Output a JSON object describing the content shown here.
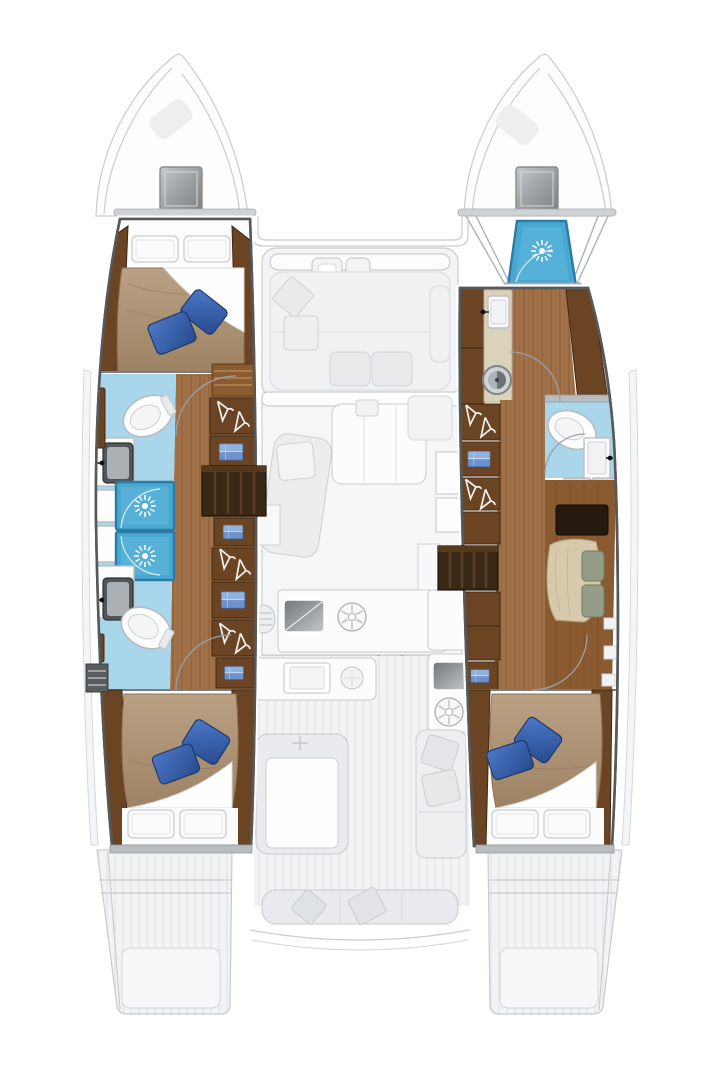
{
  "diagram": {
    "label": "catamaran-interior-deck-plan",
    "type": "boat-floor-plan",
    "orientation": "bow-up"
  },
  "palette": {
    "bg": "#ffffff",
    "ghost_fill": "#f3f4f6",
    "ghost_line": "#c9ccd0",
    "ghost_dark": "#aaadb0",
    "hull_outline": "#56585a",
    "teak": "#a1714a",
    "teak_line": "#7c5026",
    "wood_dark": "#6b4423",
    "wood_deep": "#3a2817",
    "wood_light": "#8a5a30",
    "bath_floor": "#a9d6ea",
    "shower_blue": "#49a8d2",
    "shower_border": "#2b7ba3",
    "duvet_light": "#bba183",
    "duvet_dark": "#9d8264",
    "pillow_blue_light": "#4d79c7",
    "pillow_blue_dark": "#274a8e",
    "beige": "#dbd2bb",
    "sofa": "#d7caac",
    "sill": "#b9bdc0",
    "white": "#fdfdfe",
    "steel_dark": "#70767a",
    "steel_light": "#c3c7ca",
    "clothes_blue_light": "#8fb3e0",
    "clothes_blue_dark": "#6e93cc"
  },
  "areas": {
    "port_hull": [
      "forward-double-berth",
      "forward-bathroom-toilet-sink",
      "shower-stall",
      "shower-stall",
      "aft-bathroom-toilet-sink",
      "wardrobe-column-hangers-shelves",
      "companionway-stairs",
      "aft-double-berth"
    ],
    "starboard_hull": [
      "bow-shower-stall",
      "forward-washroom-sink-washer",
      "toilet-compartment-sink",
      "wardrobe-column-hangers-shelves",
      "companionway-stairs",
      "desk-and-settee",
      "aft-double-berth"
    ],
    "center_ghost": [
      "bow-hatches",
      "foredeck-cockpit-seating",
      "salon-chaise-and-table",
      "galley-sink-and-burners",
      "sliding-door-arrow",
      "aft-cockpit-table-and-bench",
      "stern-bench",
      "transom-swim-platforms"
    ]
  },
  "icons": [
    "shower-spray-icon",
    "hanger-icon",
    "burner-icon",
    "toilet-icon",
    "sink-icon",
    "washing-machine-icon",
    "folded-clothes-icon",
    "deck-hatch-icon"
  ]
}
